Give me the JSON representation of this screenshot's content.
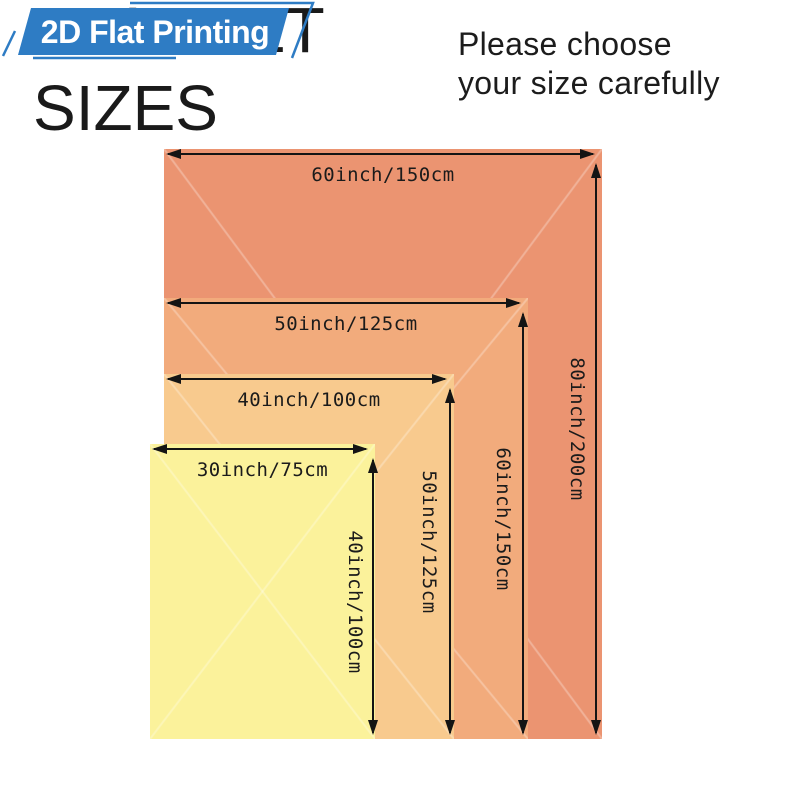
{
  "page": {
    "background": "#ffffff"
  },
  "badge": {
    "label": "2D Flat Printing",
    "color": "#2e7cc4",
    "text_color": "#ffffff"
  },
  "heading": {
    "line1": "BLANKET",
    "line2": "SIZES",
    "color": "#1a1a1a"
  },
  "note": {
    "line1": "Please choose",
    "line2": "your size carefully",
    "color": "#1c1c1c"
  },
  "diagram": {
    "arrow_color": "#141414",
    "label_color": "#1b1b1b",
    "sizes": [
      {
        "id": "60x80",
        "width_label": "60inch/150cm",
        "height_label": "80inch/200cm",
        "color": "#eb9471"
      },
      {
        "id": "50x60",
        "width_label": "50inch/125cm",
        "height_label": "60inch/150cm",
        "color": "#f2ab7c"
      },
      {
        "id": "40x50",
        "width_label": "40inch/100cm",
        "height_label": "50inch/125cm",
        "color": "#f8ca8e"
      },
      {
        "id": "30x40",
        "width_label": "30inch/75cm",
        "height_label": "40inch/100cm",
        "color": "#fbf29b"
      }
    ]
  }
}
